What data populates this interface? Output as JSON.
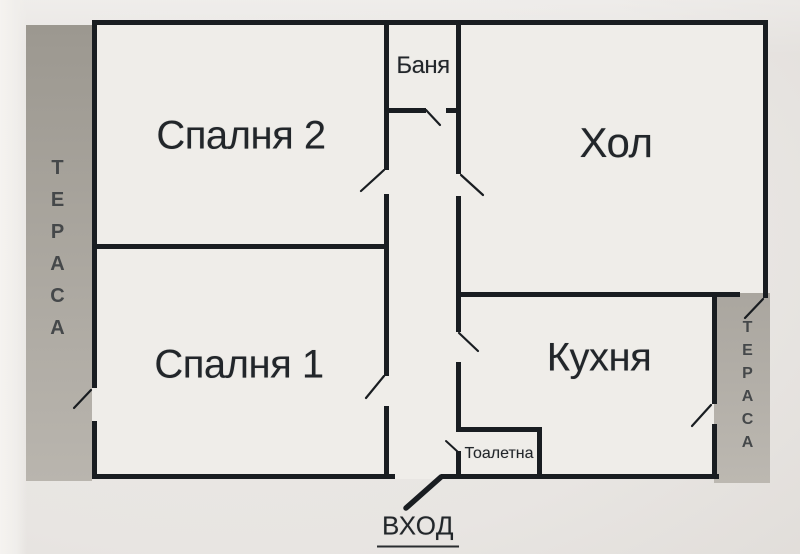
{
  "plan_title": "apartment-floor-plan",
  "rooms": {
    "bedroom2": {
      "label": "Спалня 2"
    },
    "living": {
      "label": "Хол"
    },
    "bath": {
      "label": "Баня"
    },
    "bedroom1": {
      "label": "Спалня 1"
    },
    "kitchen": {
      "label": "Кухня"
    },
    "toilet": {
      "label": "Тоалетна"
    }
  },
  "terraces": {
    "left": {
      "label": "ТЕРАСА"
    },
    "right": {
      "label": "ТЕРАСА"
    }
  },
  "entrance": {
    "label": "ВХОД"
  },
  "colors": {
    "wall": "#191d21",
    "floor": "#efede9",
    "background": "#e8e5e2",
    "terrace_left": "#a5a19a",
    "terrace_right": "#b0aca5",
    "text": "#22262a",
    "terrace_text": "#45484a"
  }
}
